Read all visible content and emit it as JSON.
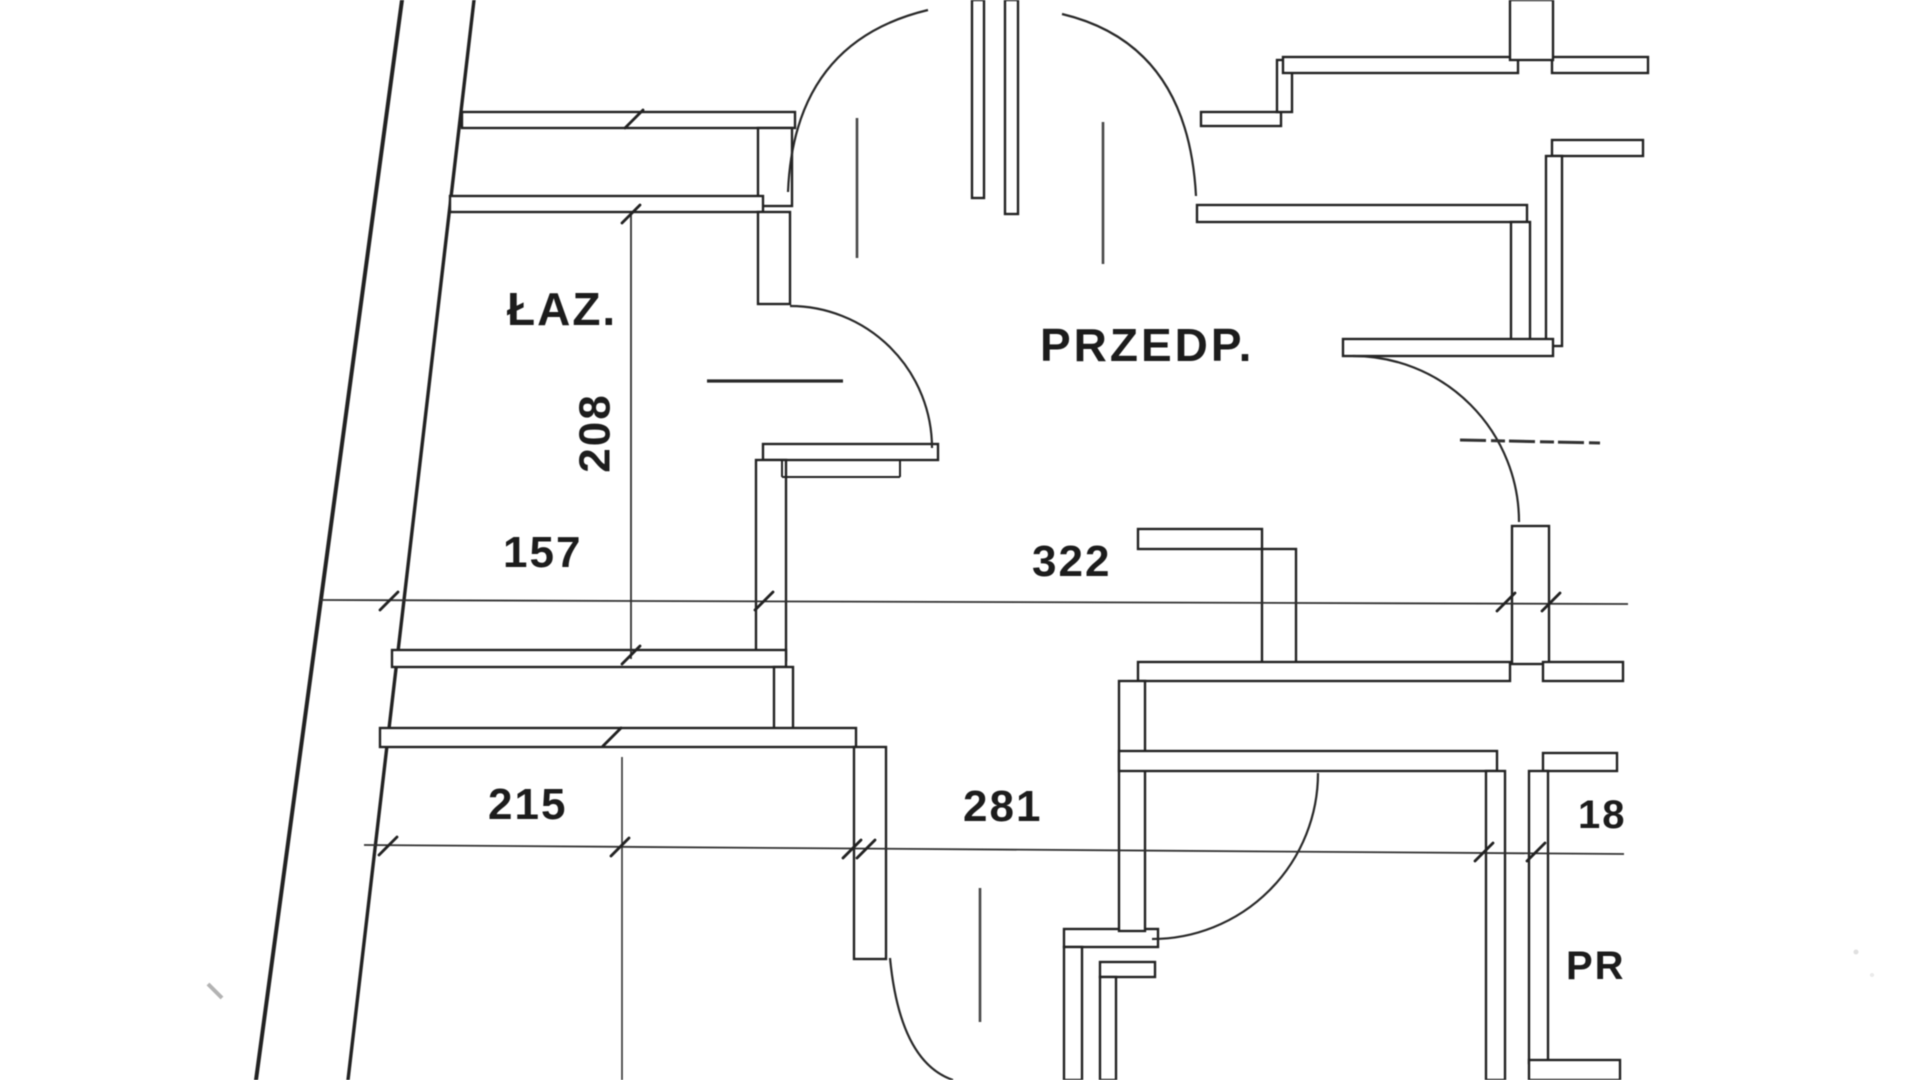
{
  "colors": {
    "ink": "#242424",
    "paper": "#ffffff"
  },
  "rooms": {
    "bathroom": {
      "label": "ŁAZ."
    },
    "hallway": {
      "label": "PRZEDP."
    },
    "room_cut": {
      "label": "PR"
    }
  },
  "dimensions": {
    "bathroom_depth": {
      "value": "208"
    },
    "bathroom_width": {
      "value": "157"
    },
    "hallway_width": {
      "value": "322"
    },
    "lower_left_width": {
      "value": "215"
    },
    "lower_mid_width": {
      "value": "281"
    },
    "right_pier_width": {
      "value": "18"
    }
  }
}
